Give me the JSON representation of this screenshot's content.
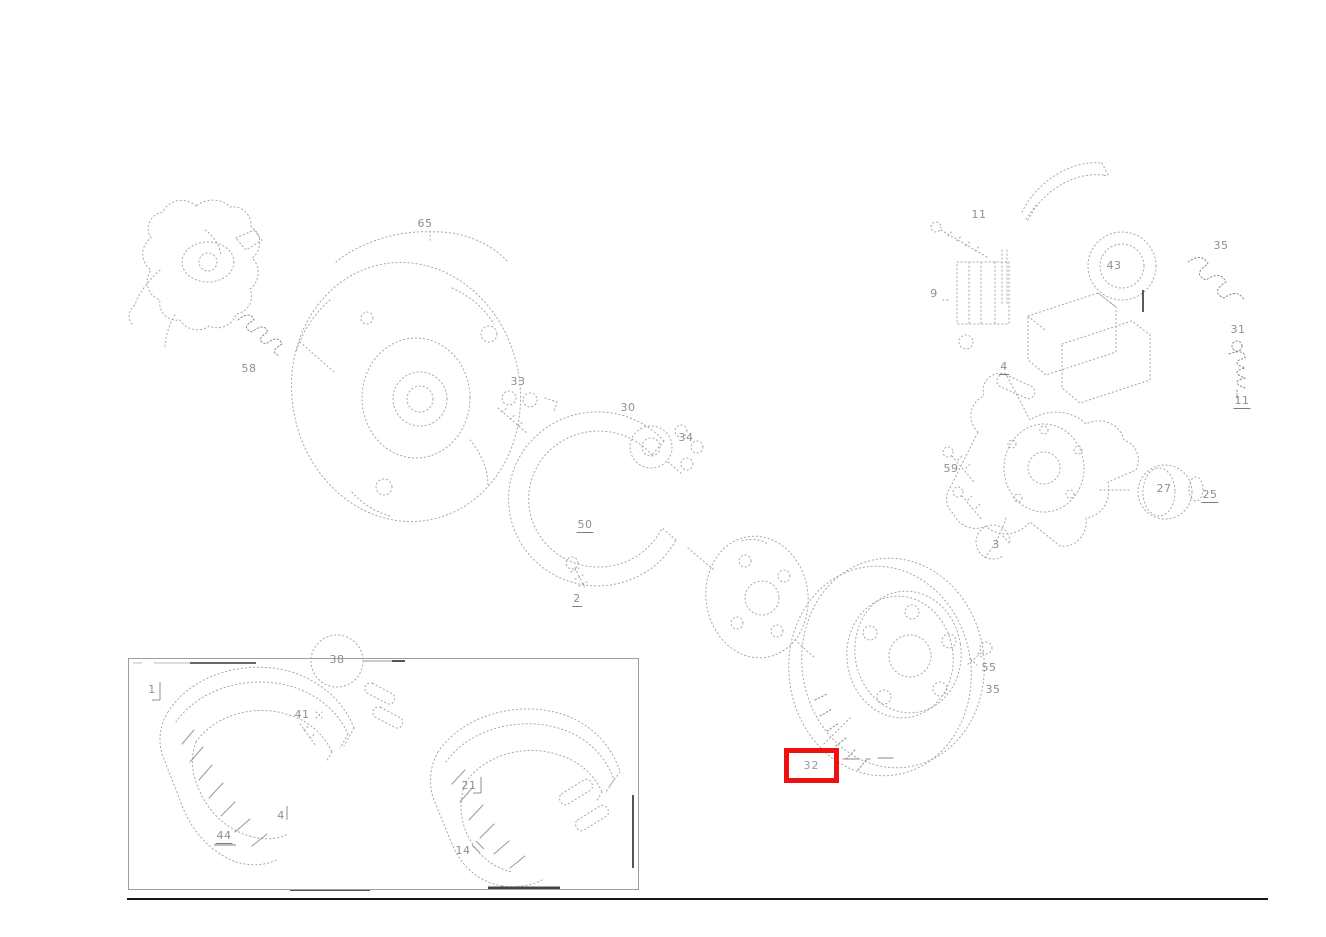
{
  "colors": {
    "background": "#ffffff",
    "line_art": "#a6a6a6",
    "line_art_dark": "#777777",
    "label_text": "#8f8f8f",
    "highlight_red": "#ee1111",
    "bottom_rule": "#161616",
    "inset_border": "#9e9e9e"
  },
  "diagram": {
    "description": "Exploded parts diagram of a front wheel brake assembly (dust shield, hub, brake disc, caliper, brake pads) with numbered part callouts; part 32 (brake disc) is highlighted with a red selection box. A detail inset at bottom-left shows the brake pads.",
    "highlight": {
      "label": "32",
      "box": {
        "x": 784,
        "y": 748,
        "w": 55,
        "h": 35,
        "border": 5
      }
    },
    "callouts": [
      {
        "text": "65",
        "x": 425,
        "y": 224
      },
      {
        "text": "58",
        "x": 249,
        "y": 369
      },
      {
        "text": "33",
        "x": 518,
        "y": 382
      },
      {
        "text": "30",
        "x": 628,
        "y": 408
      },
      {
        "text": "34",
        "x": 686,
        "y": 438
      },
      {
        "text": "50",
        "x": 585,
        "y": 526,
        "underline": true
      },
      {
        "text": "2",
        "x": 577,
        "y": 600,
        "underline": true
      },
      {
        "text": "55",
        "x": 989,
        "y": 668
      },
      {
        "text": "35",
        "x": 993,
        "y": 690
      },
      {
        "text": "11",
        "x": 979,
        "y": 215
      },
      {
        "text": "9",
        "x": 934,
        "y": 294
      },
      {
        "text": "43",
        "x": 1114,
        "y": 266
      },
      {
        "text": "35",
        "x": 1221,
        "y": 246
      },
      {
        "text": "31",
        "x": 1238,
        "y": 330
      },
      {
        "text": "11",
        "x": 1242,
        "y": 402,
        "underline": true
      },
      {
        "text": "4",
        "x": 1004,
        "y": 368,
        "underline": true
      },
      {
        "text": "59",
        "x": 951,
        "y": 469
      },
      {
        "text": "27",
        "x": 1164,
        "y": 489
      },
      {
        "text": "25",
        "x": 1210,
        "y": 496,
        "underline": true
      },
      {
        "text": "3",
        "x": 996,
        "y": 545
      },
      {
        "text": "1",
        "x": 152,
        "y": 690
      },
      {
        "text": "38",
        "x": 337,
        "y": 660
      },
      {
        "text": "41",
        "x": 302,
        "y": 715
      },
      {
        "text": "4",
        "x": 281,
        "y": 816
      },
      {
        "text": "44",
        "x": 224,
        "y": 837,
        "underline": true
      },
      {
        "text": "21",
        "x": 469,
        "y": 786
      },
      {
        "text": "14",
        "x": 463,
        "y": 851
      }
    ]
  }
}
